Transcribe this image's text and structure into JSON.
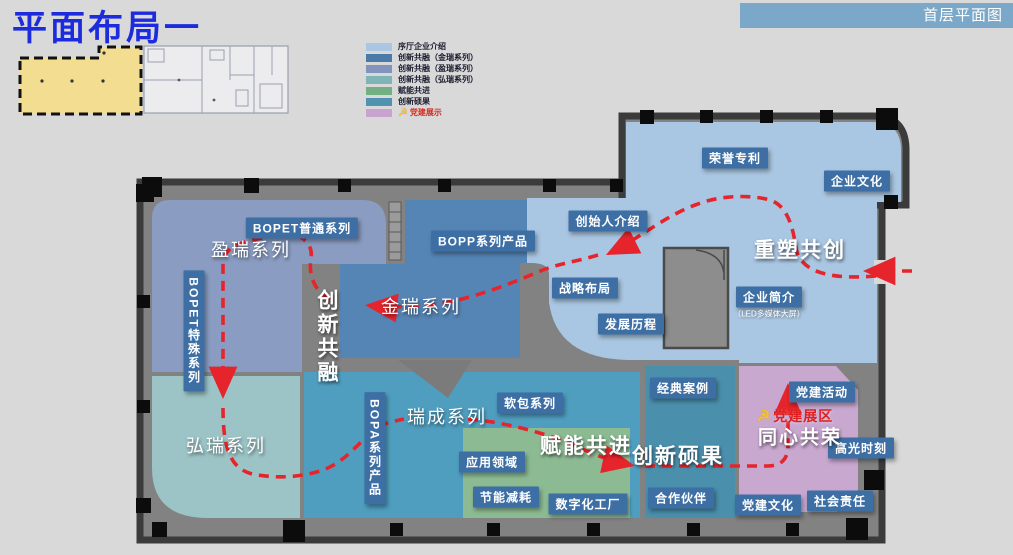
{
  "slide": {
    "title": "平面布局一",
    "corner_tag": "首层平面图"
  },
  "legend": {
    "items": [
      {
        "label": "序厅企业介绍",
        "color": "#a9c6e2"
      },
      {
        "label": "创新共融（金瑞系列）",
        "color": "#4a7aa8"
      },
      {
        "label": "创新共融（盈瑞系列）",
        "color": "#8294bd"
      },
      {
        "label": "创新共融（弘瑞系列）",
        "color": "#80b5b8"
      },
      {
        "label": "赋能共进",
        "color": "#72b083"
      },
      {
        "label": "创新硕果",
        "color": "#4f93b0"
      },
      {
        "label": "党建展示",
        "color": "#c9a3cf",
        "icon": "party-emblem",
        "emblem": "☭",
        "text_color": "#d42b1e"
      }
    ]
  },
  "map": {
    "zone_names": {
      "yingrui": "盈瑞系列",
      "jinrui": "金瑞系列",
      "hongrui": "弘瑞系列",
      "ruicheng": "瑞成系列"
    },
    "themes": {
      "reshape": "重塑共创",
      "fusion": "创新共融",
      "empower": "赋能共进",
      "achievements": "创新硕果",
      "glory": "同心共荣"
    },
    "party": {
      "emblem": "☭",
      "zone_title": "党建展区"
    },
    "labels": {
      "honor_patents": "荣誉专利",
      "corporate_culture": "企业文化",
      "founder_intro": "创始人介绍",
      "strategy_layout": "战略布局",
      "development_history": "发展历程",
      "company_profile": "企业简介",
      "company_profile_sub": "（LED多媒体大屏）",
      "soft_packaging": "软包系列",
      "application_fields": "应用领域",
      "energy_saving": "节能减耗",
      "digital_factory": "数字化工厂",
      "classic_cases": "经典案例",
      "partners": "合作伙伴",
      "party_activities": "党建活动",
      "highlight_moments": "高光时刻",
      "party_culture": "党建文化",
      "social_responsibility": "社会责任",
      "bopet_regular": "BOPET普通系列",
      "bopp_series": "BOPP系列产品",
      "bopet_special": "BOPET特殊系列",
      "bopa_series": "BOPA系列产品"
    },
    "route": {
      "color": "#e6242b",
      "style": "dashed",
      "entry": "right-side-entrance"
    }
  },
  "colors": {
    "background": "#d9d9d9",
    "title": "#1c2bdb",
    "header_bar": "#7ba8c9",
    "wall": "#3b3b3b",
    "floor": "#828282",
    "label_box": "#3d6fa5",
    "zone_lobby": "#a9c6e2",
    "zone_jinrui": "#5585b5",
    "zone_yingrui": "#8a9cc2",
    "zone_hongrui": "#9cc4c6",
    "zone_ruicheng": "#4f9ec0",
    "zone_empower": "#8cbb93",
    "zone_achievements": "#4a90ad",
    "zone_party": "#c9a8d0",
    "thumbnail_highlight": "#f2dd90"
  }
}
